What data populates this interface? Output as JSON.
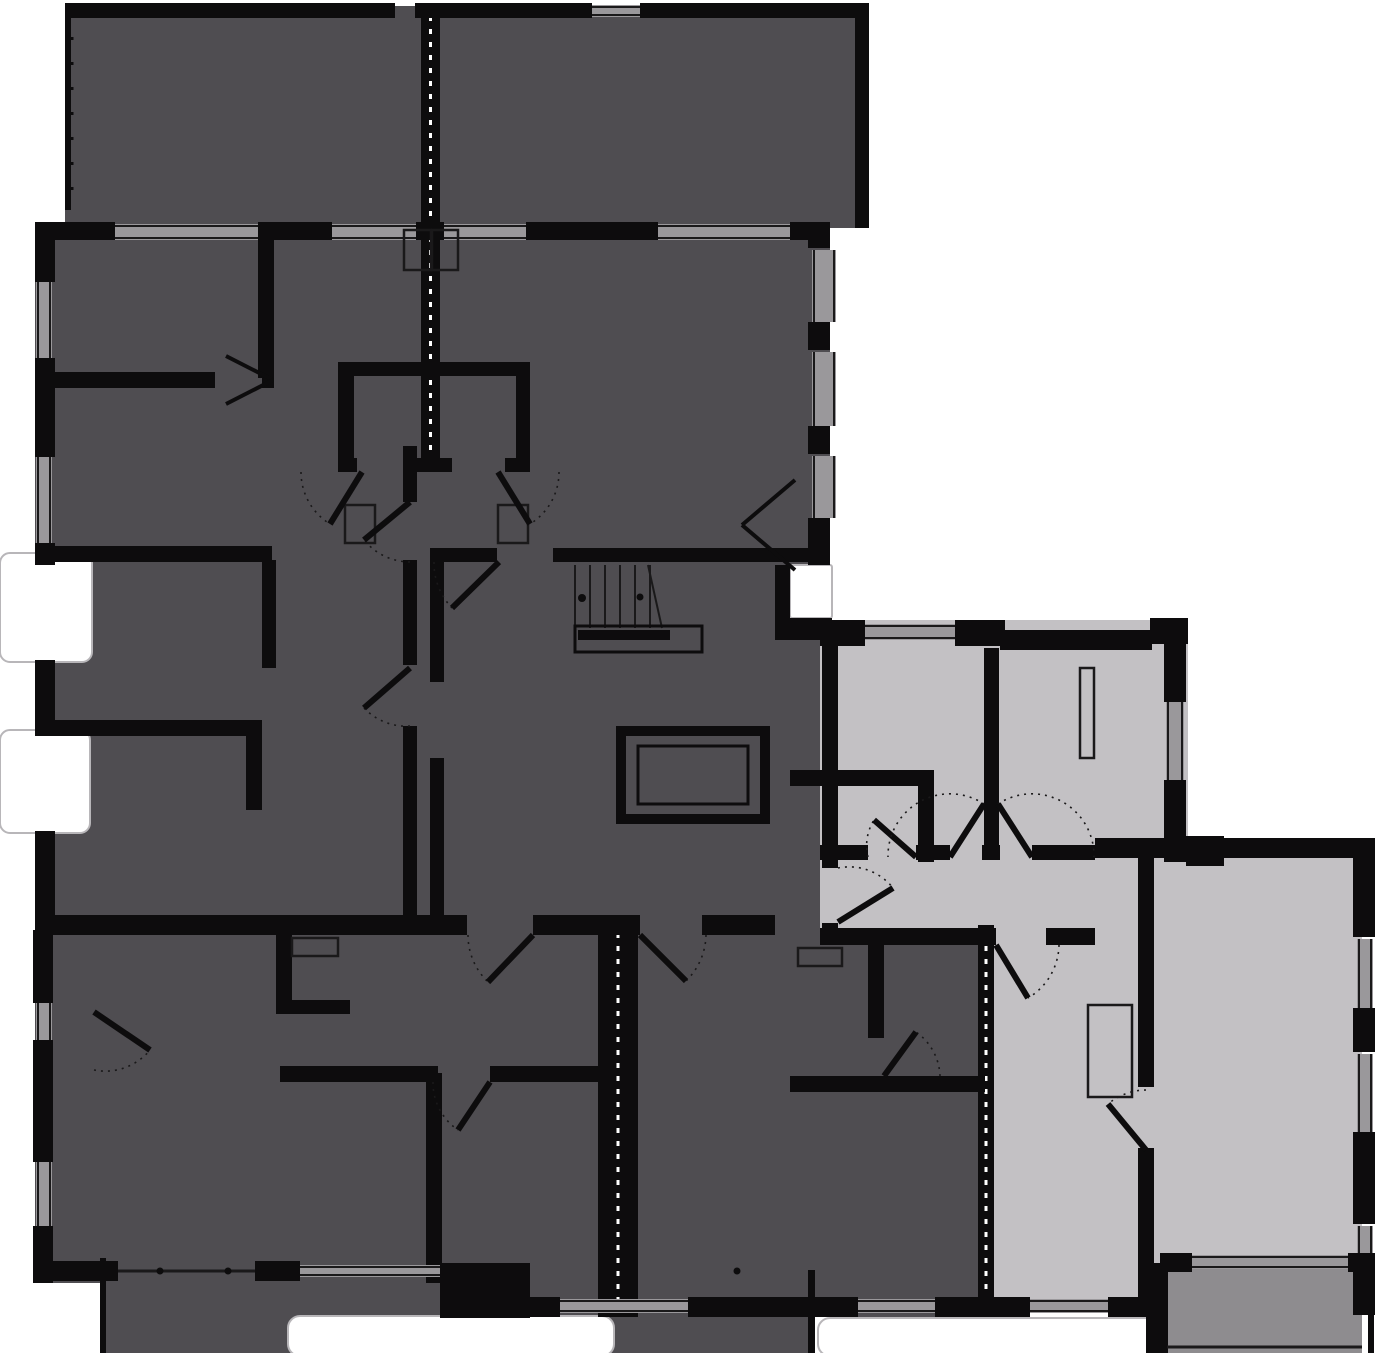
{
  "title": "apartment-building-floor-plan",
  "colors": {
    "background": "#ffffff",
    "inactive_unit": "#4f4d51",
    "highlight_unit": "#c3c1c4",
    "highlight_terrace": "#8e8c8f",
    "wall": "#0d0c0d",
    "window": "#9a989b",
    "line": "#1a191a",
    "inset_stroke": "#b8b6b9"
  },
  "plan": {
    "width": 1381,
    "height": 1353,
    "masses": [
      {
        "name": "terrace-top",
        "fill": "dark",
        "x": 65,
        "y": 6,
        "w": 803,
        "h": 222
      },
      {
        "name": "block-upper",
        "fill": "dark",
        "x": 35,
        "y": 222,
        "w": 795,
        "h": 343
      },
      {
        "name": "block-mid",
        "fill": "dark",
        "x": 35,
        "y": 565,
        "w": 795,
        "h": 368
      },
      {
        "name": "unit-bottom-left",
        "fill": "dark",
        "x": 35,
        "y": 930,
        "w": 577,
        "h": 353
      },
      {
        "name": "terrace-bottom",
        "fill": "dark",
        "x": 100,
        "y": 1258,
        "w": 715,
        "h": 95
      },
      {
        "name": "unit-bottom-middle",
        "fill": "dark",
        "x": 612,
        "y": 930,
        "w": 373,
        "h": 387
      },
      {
        "name": "unit2-rooms-top",
        "fill": "light",
        "x": 820,
        "y": 620,
        "w": 368,
        "h": 242
      },
      {
        "name": "unit2-hall",
        "fill": "light",
        "x": 820,
        "y": 855,
        "w": 370,
        "h": 90
      },
      {
        "name": "unit2-living",
        "fill": "light",
        "x": 1095,
        "y": 838,
        "w": 267,
        "h": 432
      },
      {
        "name": "unit2-bedroom",
        "fill": "light",
        "x": 985,
        "y": 940,
        "w": 165,
        "h": 360
      },
      {
        "name": "terrace-unit2",
        "fill": "medium",
        "x": 1160,
        "y": 1267,
        "w": 202,
        "h": 86
      }
    ],
    "notches": [
      {
        "name": "notch-left-upper",
        "x": 0,
        "y": 553,
        "w": 92,
        "h": 109,
        "rx": 10
      },
      {
        "name": "notch-left-lower",
        "x": 0,
        "y": 730,
        "w": 90,
        "h": 103,
        "rx": 10
      },
      {
        "name": "notch-core-right",
        "x": 790,
        "y": 565,
        "w": 42,
        "h": 53,
        "rx": 2
      },
      {
        "name": "terrace-inset-left",
        "x": 288,
        "y": 1316,
        "w": 326,
        "h": 40,
        "rx": 12
      },
      {
        "name": "terrace-inset-right",
        "x": 818,
        "y": 1318,
        "w": 342,
        "h": 38,
        "rx": 12
      }
    ],
    "party_walls": [
      {
        "name": "party-wall-top",
        "x": 421,
        "y": 8,
        "w": 19,
        "h": 462,
        "dash": true
      },
      {
        "name": "party-wall-bottom-left",
        "x": 598,
        "y": 925,
        "w": 40,
        "h": 392,
        "dash": true
      },
      {
        "name": "party-wall-bottom-right",
        "x": 978,
        "y": 925,
        "w": 16,
        "h": 392,
        "dash": true
      }
    ],
    "walls": [
      [
        65,
        3,
        330,
        15
      ],
      [
        415,
        3,
        177,
        15
      ],
      [
        640,
        3,
        215,
        15
      ],
      [
        855,
        3,
        14,
        225
      ],
      [
        65,
        3,
        6,
        207
      ],
      [
        35,
        222,
        80,
        18
      ],
      [
        258,
        222,
        74,
        18
      ],
      [
        416,
        222,
        28,
        18
      ],
      [
        526,
        222,
        132,
        18
      ],
      [
        790,
        222,
        40,
        18
      ],
      [
        35,
        222,
        20,
        60
      ],
      [
        35,
        358,
        20,
        99
      ],
      [
        35,
        543,
        20,
        22
      ],
      [
        35,
        660,
        20,
        72
      ],
      [
        35,
        831,
        20,
        99
      ],
      [
        808,
        222,
        22,
        26
      ],
      [
        808,
        322,
        22,
        28
      ],
      [
        808,
        426,
        22,
        28
      ],
      [
        808,
        518,
        22,
        47
      ],
      [
        775,
        565,
        15,
        55
      ],
      [
        775,
        618,
        57,
        22
      ],
      [
        258,
        222,
        16,
        156
      ],
      [
        35,
        372,
        180,
        16
      ],
      [
        262,
        372,
        12,
        16
      ],
      [
        35,
        546,
        237,
        16
      ],
      [
        262,
        560,
        14,
        108
      ],
      [
        35,
        720,
        227,
        16
      ],
      [
        246,
        720,
        16,
        90
      ],
      [
        403,
        446,
        14,
        56
      ],
      [
        403,
        560,
        14,
        105
      ],
      [
        403,
        726,
        14,
        191
      ],
      [
        338,
        362,
        192,
        14
      ],
      [
        338,
        362,
        16,
        110
      ],
      [
        516,
        362,
        14,
        110
      ],
      [
        338,
        458,
        19,
        14
      ],
      [
        408,
        458,
        44,
        14
      ],
      [
        505,
        458,
        25,
        14
      ],
      [
        430,
        548,
        67,
        14
      ],
      [
        553,
        548,
        277,
        14
      ],
      [
        430,
        562,
        14,
        120
      ],
      [
        430,
        758,
        14,
        157
      ],
      [
        35,
        915,
        432,
        20
      ],
      [
        533,
        915,
        107,
        20
      ],
      [
        702,
        915,
        73,
        20
      ],
      [
        820,
        620,
        45,
        26
      ],
      [
        955,
        620,
        50,
        26
      ],
      [
        1000,
        630,
        152,
        20
      ],
      [
        1150,
        618,
        38,
        26
      ],
      [
        1164,
        640,
        22,
        62
      ],
      [
        1164,
        780,
        22,
        82
      ],
      [
        1186,
        836,
        38,
        30
      ],
      [
        984,
        648,
        15,
        197
      ],
      [
        790,
        770,
        140,
        16
      ],
      [
        918,
        770,
        16,
        92
      ],
      [
        820,
        845,
        48,
        15
      ],
      [
        916,
        845,
        34,
        15
      ],
      [
        982,
        845,
        18,
        15
      ],
      [
        1032,
        845,
        63,
        15
      ],
      [
        822,
        640,
        16,
        228
      ],
      [
        822,
        923,
        16,
        22
      ],
      [
        1095,
        838,
        267,
        20
      ],
      [
        1138,
        858,
        16,
        48
      ],
      [
        820,
        928,
        176,
        17
      ],
      [
        1046,
        928,
        49,
        17
      ],
      [
        1138,
        905,
        16,
        182
      ],
      [
        1138,
        1148,
        16,
        152
      ],
      [
        1160,
        1253,
        32,
        19
      ],
      [
        1348,
        1253,
        14,
        19
      ],
      [
        1353,
        838,
        22,
        99
      ],
      [
        1353,
        1008,
        22,
        44
      ],
      [
        1353,
        1132,
        22,
        92
      ],
      [
        1353,
        1253,
        22,
        17
      ],
      [
        1146,
        1263,
        22,
        90
      ],
      [
        1353,
        1270,
        22,
        45
      ],
      [
        1368,
        1315,
        6,
        38
      ],
      [
        33,
        930,
        20,
        73
      ],
      [
        33,
        1040,
        20,
        122
      ],
      [
        33,
        1226,
        20,
        57
      ],
      [
        33,
        1261,
        85,
        20
      ],
      [
        255,
        1261,
        45,
        20
      ],
      [
        440,
        1263,
        90,
        55
      ],
      [
        530,
        1297,
        30,
        20
      ],
      [
        688,
        1297,
        170,
        20
      ],
      [
        935,
        1297,
        95,
        20
      ],
      [
        1108,
        1297,
        52,
        20
      ],
      [
        276,
        930,
        16,
        84
      ],
      [
        276,
        1000,
        74,
        14
      ],
      [
        426,
        1073,
        16,
        210
      ],
      [
        280,
        1066,
        158,
        16
      ],
      [
        490,
        1066,
        122,
        16
      ],
      [
        868,
        930,
        16,
        108
      ],
      [
        790,
        1076,
        195,
        16
      ],
      [
        100,
        1258,
        6,
        95
      ],
      [
        808,
        1270,
        7,
        83
      ]
    ],
    "windows": [
      {
        "x": 115,
        "y": 224,
        "w": 143,
        "h": 16,
        "o": "h",
        "name": "window-top-1"
      },
      {
        "x": 332,
        "y": 224,
        "w": 84,
        "h": 16,
        "o": "h",
        "name": "window-top-2"
      },
      {
        "x": 444,
        "y": 224,
        "w": 82,
        "h": 16,
        "o": "h",
        "name": "window-top-3"
      },
      {
        "x": 658,
        "y": 224,
        "w": 132,
        "h": 16,
        "o": "h",
        "name": "window-top-4"
      },
      {
        "x": 592,
        "y": 5,
        "w": 48,
        "h": 12,
        "o": "h",
        "name": "window-terrace"
      },
      {
        "x": 36,
        "y": 282,
        "w": 16,
        "h": 76,
        "o": "v",
        "name": "window-left-1"
      },
      {
        "x": 36,
        "y": 457,
        "w": 16,
        "h": 86,
        "o": "v",
        "name": "window-left-2"
      },
      {
        "x": 36,
        "y": 1003,
        "w": 16,
        "h": 37,
        "o": "v",
        "name": "window-left-3"
      },
      {
        "x": 36,
        "y": 1162,
        "w": 16,
        "h": 64,
        "o": "v",
        "name": "window-left-4"
      },
      {
        "x": 812,
        "y": 250,
        "w": 24,
        "h": 72,
        "o": "v",
        "name": "window-right-upper-1"
      },
      {
        "x": 812,
        "y": 352,
        "w": 24,
        "h": 74,
        "o": "v",
        "name": "window-right-upper-2"
      },
      {
        "x": 812,
        "y": 456,
        "w": 24,
        "h": 62,
        "o": "v",
        "name": "window-right-upper-3"
      },
      {
        "x": 865,
        "y": 624,
        "w": 90,
        "h": 16,
        "o": "h",
        "name": "window-unit2-room-a"
      },
      {
        "x": 1166,
        "y": 702,
        "w": 18,
        "h": 78,
        "o": "v",
        "name": "window-unit2-room-b"
      },
      {
        "x": 1357,
        "y": 939,
        "w": 16,
        "h": 69,
        "o": "v",
        "name": "window-living-1"
      },
      {
        "x": 1357,
        "y": 1054,
        "w": 16,
        "h": 78,
        "o": "v",
        "name": "window-living-2"
      },
      {
        "x": 1357,
        "y": 1226,
        "w": 16,
        "h": 27,
        "o": "v",
        "name": "window-living-3"
      },
      {
        "x": 1192,
        "y": 1255,
        "w": 156,
        "h": 14,
        "o": "h",
        "name": "window-living-terrace-door"
      },
      {
        "x": 1030,
        "y": 1299,
        "w": 78,
        "h": 14,
        "o": "h",
        "name": "window-bedroom"
      },
      {
        "x": 560,
        "y": 1299,
        "w": 128,
        "h": 14,
        "o": "h",
        "name": "window-bottom-middle-1"
      },
      {
        "x": 858,
        "y": 1299,
        "w": 77,
        "h": 14,
        "o": "h",
        "name": "window-bottom-middle-2"
      },
      {
        "x": 300,
        "y": 1265,
        "w": 140,
        "h": 12,
        "o": "h",
        "name": "window-bottom-left"
      }
    ],
    "stairs": {
      "name": "staircase",
      "tread_x1": 575,
      "tread_x2": 650,
      "tread_step": 15,
      "tread_y1": 565,
      "tread_y2": 628,
      "diagonal": [
        648,
        565,
        662,
        628
      ],
      "newel_dot": [
        582,
        598
      ],
      "rail_bar": [
        578,
        630,
        92,
        10
      ],
      "rail_outline": [
        575,
        626,
        127,
        26
      ]
    },
    "elevator": {
      "name": "elevator",
      "frame": [
        616,
        726,
        154,
        98
      ],
      "cab": [
        626,
        736,
        134,
        78
      ],
      "inner": [
        638,
        746,
        110,
        58
      ]
    },
    "fixtures": [
      {
        "x": 292,
        "y": 938,
        "w": 46,
        "h": 18,
        "name": "fixture-bathroom"
      },
      {
        "x": 798,
        "y": 948,
        "w": 44,
        "h": 18,
        "name": "fixture-bathroom"
      },
      {
        "x": 345,
        "y": 505,
        "w": 30,
        "h": 38,
        "name": "fixture-wc"
      },
      {
        "x": 498,
        "y": 505,
        "w": 30,
        "h": 38,
        "name": "fixture-wc"
      },
      {
        "x": 1088,
        "y": 1005,
        "w": 44,
        "h": 92,
        "name": "wardrobe"
      },
      {
        "x": 1080,
        "y": 668,
        "w": 14,
        "h": 90,
        "name": "radiator"
      },
      {
        "x": 404,
        "y": 230,
        "w": 27,
        "h": 40,
        "name": "vent-shaft"
      },
      {
        "x": 432,
        "y": 230,
        "w": 26,
        "h": 40,
        "name": "vent-shaft"
      }
    ],
    "doors": [
      {
        "name": "door-unit2-entry",
        "leaf": [
          838,
          922,
          893,
          888
        ],
        "arc": "M838,868 A56,56 0 0 1 893,888"
      },
      {
        "name": "door-unit2-closet",
        "leaf": [
          916,
          857,
          874,
          820
        ],
        "arc": "M868,857 A48,48 0 0 1 874,820"
      },
      {
        "name": "door-unit2-room-a",
        "leaf": [
          950,
          857,
          984,
          804
        ],
        "arc": "M984,804 A62,62 0 0 0 888,857"
      },
      {
        "name": "door-unit2-room-b",
        "leaf": [
          1032,
          857,
          998,
          804
        ],
        "arc": "M998,804 A62,62 0 0 1 1094,857"
      },
      {
        "name": "door-unit2-bedroom",
        "leaf": [
          996,
          945,
          1028,
          998
        ],
        "arc": "M1059,945 A63,63 0 0 1 1028,998"
      },
      {
        "name": "door-bedroom-living",
        "leaf": [
          1146,
          1150,
          1108,
          1104
        ],
        "arc": "M1146,1090 A60,60 0 0 0 1108,1104"
      },
      {
        "name": "door-stair-core",
        "leaf": [
          499,
          562,
          452,
          608
        ],
        "arc": "M434,562 A65,65 0 0 0 452,608"
      },
      {
        "name": "door-unit-bottom-left-entry",
        "leaf": [
          533,
          935,
          488,
          982
        ],
        "arc": "M468,935 A65,65 0 0 0 488,982"
      },
      {
        "name": "door-unit-bottom-middle-entry",
        "leaf": [
          640,
          935,
          686,
          981
        ],
        "arc": "M706,935 A66,66 0 0 1 686,981"
      },
      {
        "name": "door-bath-left",
        "leaf": [
          362,
          472,
          330,
          524
        ],
        "arc": "M301,472 A61,61 0 0 0 330,524"
      },
      {
        "name": "door-bath-right",
        "leaf": [
          498,
          472,
          530,
          524
        ],
        "arc": "M559,472 A61,61 0 0 1 530,524"
      },
      {
        "name": "door-corridor-1",
        "leaf": [
          410,
          502,
          364,
          540
        ],
        "arc": "M410,562 A60,60 0 0 1 364,540"
      },
      {
        "name": "door-corridor-2",
        "leaf": [
          410,
          668,
          364,
          708
        ],
        "arc": "M410,726 A58,58 0 0 1 364,708"
      },
      {
        "name": "door-bottom-left-room",
        "leaf": [
          94,
          1012,
          150,
          1050
        ],
        "arc": "M94,1070 A58,58 0 0 0 150,1050"
      },
      {
        "name": "door-bottom-middle-bath",
        "leaf": [
          884,
          1076,
          916,
          1032
        ],
        "arc": "M940,1076 A56,56 0 0 0 916,1032"
      },
      {
        "name": "door-bottom-left-inner",
        "leaf": [
          490,
          1082,
          458,
          1130
        ],
        "arc": "M433,1082 A57,57 0 0 0 458,1130"
      }
    ],
    "door_marks": [
      {
        "name": "double-door-mark-left-room",
        "lines": [
          [
            273,
            380,
            226,
            356
          ],
          [
            273,
            380,
            226,
            404
          ]
        ]
      },
      {
        "name": "double-door-mark-right-room",
        "lines": [
          [
            742,
            525,
            795,
            480
          ],
          [
            742,
            525,
            795,
            570
          ]
        ]
      }
    ],
    "thin_lines": [
      {
        "name": "sliding-door-track",
        "pts": [
          118,
          1271,
          255,
          1271
        ]
      },
      {
        "name": "terrace-unit2-edge",
        "pts": [
          1167,
          1347,
          1362,
          1347
        ]
      }
    ],
    "dashed_edges": [
      {
        "name": "terrace-top-left-edge",
        "pts": [
          72,
          12,
          72,
          210
        ]
      }
    ],
    "dots": [
      [
        160,
        1271
      ],
      [
        228,
        1271
      ],
      [
        737,
        1271
      ],
      [
        640,
        597
      ]
    ]
  }
}
